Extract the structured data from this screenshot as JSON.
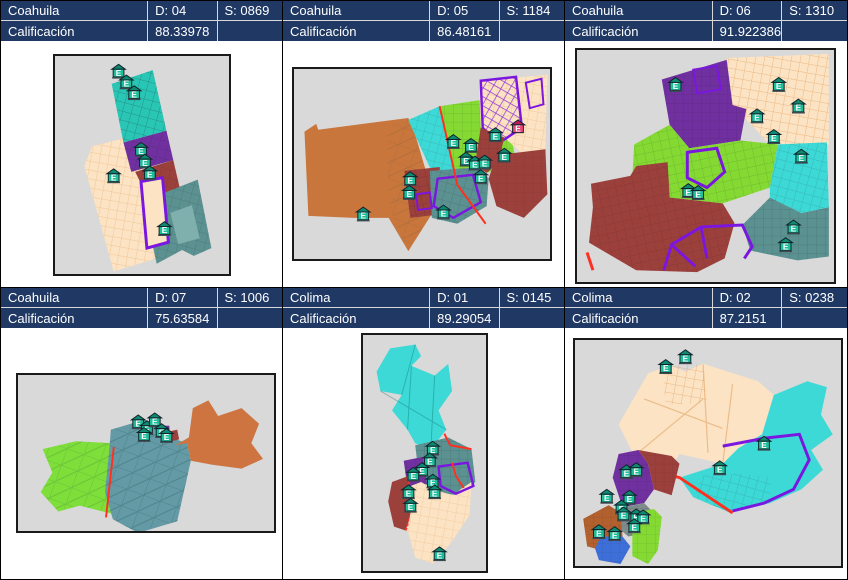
{
  "labels": {
    "calificacion": "Calificación"
  },
  "icon": {
    "letter": "E",
    "meaning": "school-marker"
  },
  "colors": {
    "header_bg": "#1f3864",
    "header_text": "#ffffff",
    "frame_bg": "#d9d9d9",
    "turquoise": "#29c5b5",
    "cyan": "#3dd9d6",
    "purple": "#7030a0",
    "purple_outline": "#7b16e0",
    "maroon": "#9c403c",
    "cream": "#fbe3c3",
    "dark_teal": "#5c9191",
    "orange": "#c9763c",
    "brown_orange": "#b2602e",
    "lime": "#84da33",
    "blue_gray": "#639aa5",
    "blue": "#3e6fd9",
    "red_line": "#ff3020",
    "icon_body": "#1fbd9a",
    "icon_roof": "#0e8a70",
    "icon_pink": "#f0447c"
  },
  "panels": [
    {
      "state": "Coahuila",
      "district": "D: 04",
      "section": "S: 0869",
      "score": "88.33978"
    },
    {
      "state": "Coahuila",
      "district": "D: 05",
      "section": "S: 1184",
      "score": "86.48161"
    },
    {
      "state": "Coahuila",
      "district": "D: 06",
      "section": "S: 1310",
      "score": "91.922386"
    },
    {
      "state": "Coahuila",
      "district": "D: 07",
      "section": "S: 1006",
      "score": "75.63584"
    },
    {
      "state": "Colima",
      "district": "D: 01",
      "section": "S: 0145",
      "score": "89.29054"
    },
    {
      "state": "Colima",
      "district": "D: 02",
      "section": "S: 0238",
      "score": "87.2151"
    }
  ]
}
